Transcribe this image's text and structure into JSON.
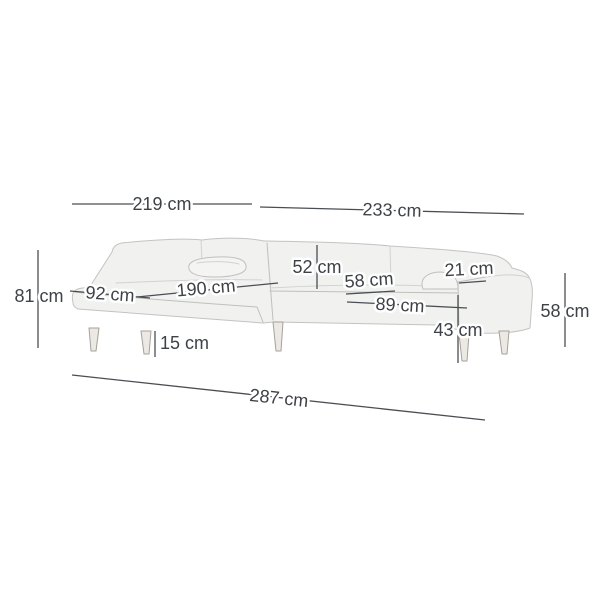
{
  "diagram": {
    "title": "Corner sofa dimension diagram",
    "unit": "cm",
    "labels": {
      "width_left": "219 cm",
      "width_right": "233 cm",
      "height_back": "81 cm",
      "depth_chaise": "92 cm",
      "length_chaise": "190 cm",
      "height_back_above_seat": "52 cm",
      "depth_seat": "58 cm",
      "width_armrest": "21 cm",
      "depth_seat_with_armrest": "89 cm",
      "height_seat": "43 cm",
      "height_armrest": "58 cm",
      "height_legs": "15 cm",
      "width_total": "287 cm"
    },
    "colors": {
      "background": "#ffffff",
      "dimension_line": "#4a4e53",
      "label_text": "#3e4247",
      "label_halo": "#ffffff",
      "sofa_fill": "#f1f1f0",
      "sofa_outline": "#c3c3c1",
      "leg_fill": "#ece9e4"
    }
  }
}
